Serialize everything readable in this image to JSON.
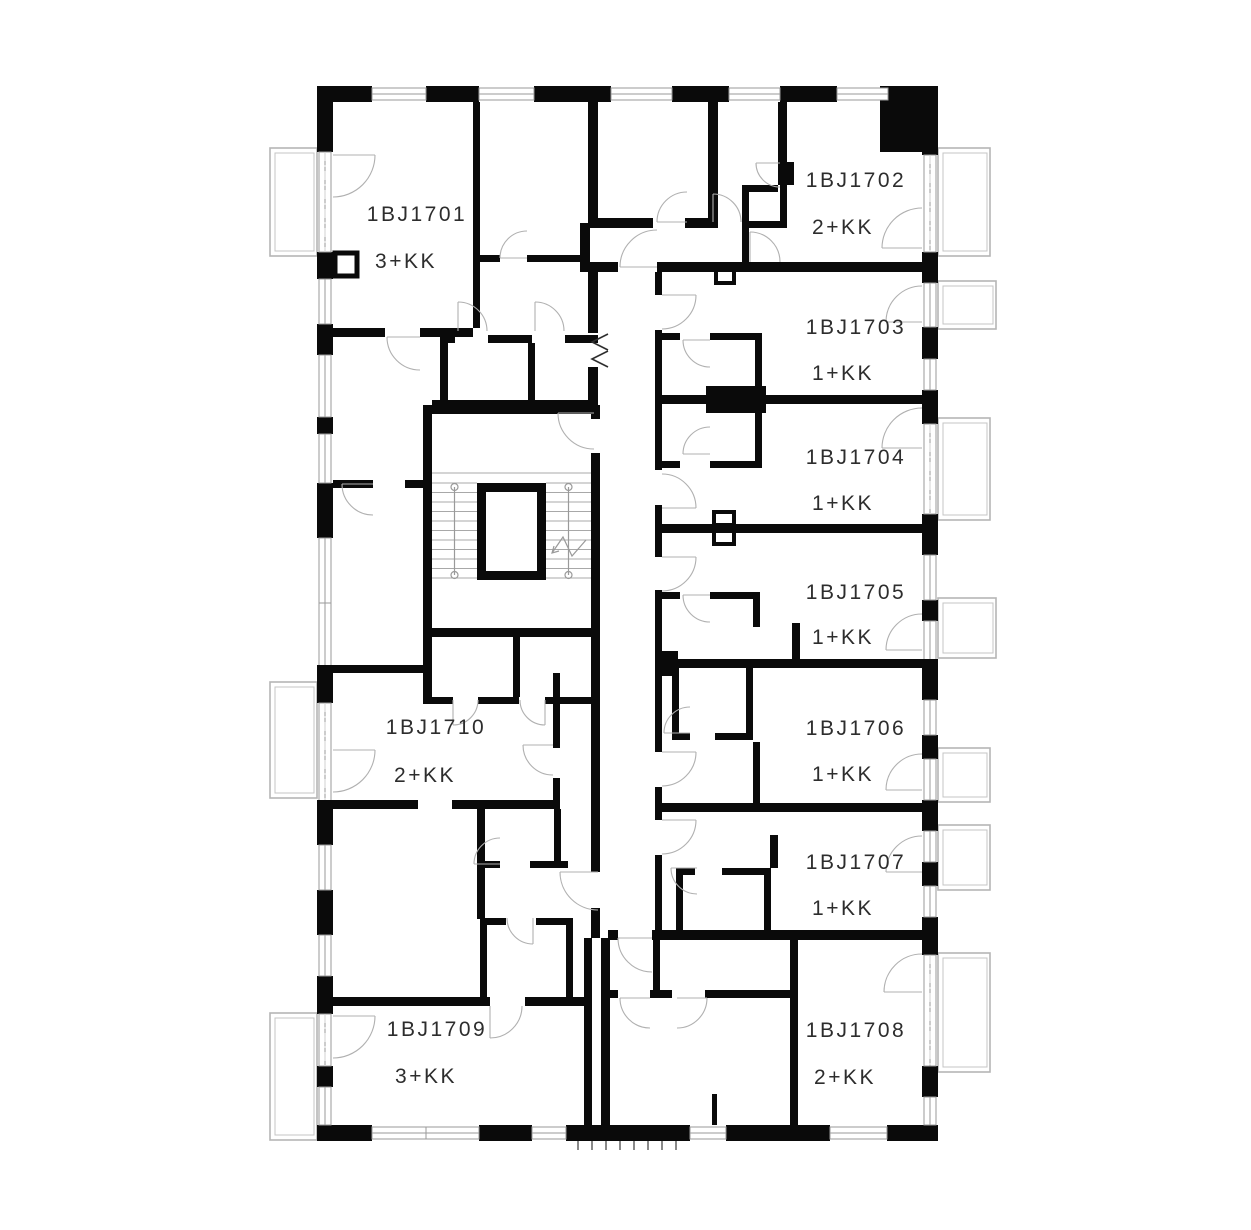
{
  "plan": {
    "units": [
      {
        "id": "1BJ1701",
        "type": "3+KK"
      },
      {
        "id": "1BJ1702",
        "type": "2+KK"
      },
      {
        "id": "1BJ1703",
        "type": "1+KK"
      },
      {
        "id": "1BJ1704",
        "type": "1+KK"
      },
      {
        "id": "1BJ1705",
        "type": "1+KK"
      },
      {
        "id": "1BJ1706",
        "type": "1+KK"
      },
      {
        "id": "1BJ1707",
        "type": "1+KK"
      },
      {
        "id": "1BJ1708",
        "type": "2+KK"
      },
      {
        "id": "1BJ1709",
        "type": "3+KK"
      },
      {
        "id": "1BJ1710",
        "type": "2+KK"
      }
    ],
    "colors": {
      "wall": "#0a0a0a",
      "thin_line": "#9a9a9a",
      "balcony_line": "#b5b5b5",
      "label": "#2d2d2d"
    }
  }
}
